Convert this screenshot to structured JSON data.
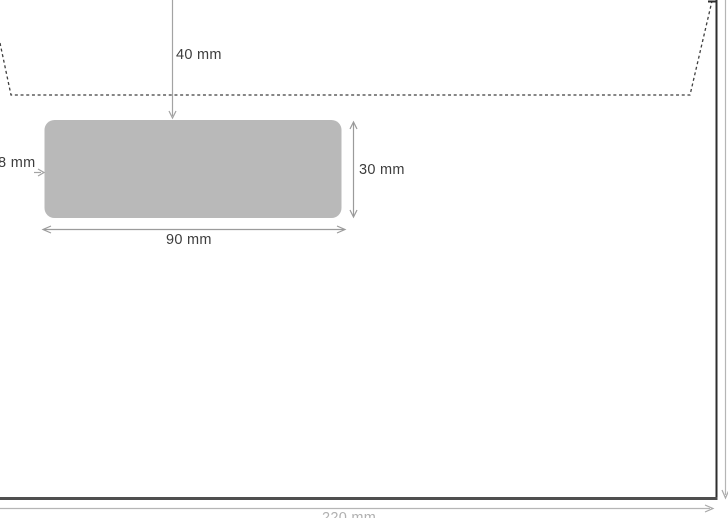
{
  "diagram": {
    "type": "envelope-window-dimension-diagram",
    "description": "Technical drawing of a windowed envelope: dashed flap fold line at top, grey address window with dimension arrows, envelope outline with overall dimension lines at right and bottom edges",
    "labels": {
      "top_offset": "40 mm",
      "left_offset": "8 mm",
      "window_height": "30 mm",
      "window_width": "90 mm",
      "envelope_width": "220 mm"
    },
    "colors": {
      "background": "#ffffff",
      "window_fill": "#b9b9b9",
      "inner_dimension_line": "#9b9b9b",
      "outer_dimension_line": "#b5b5b5",
      "envelope_edge_dark": "#2e2e2e",
      "envelope_bottom_edge": "#4f4f4f",
      "flap_dash": "#3f3f3f",
      "label_text": "#3d3d3d"
    }
  }
}
